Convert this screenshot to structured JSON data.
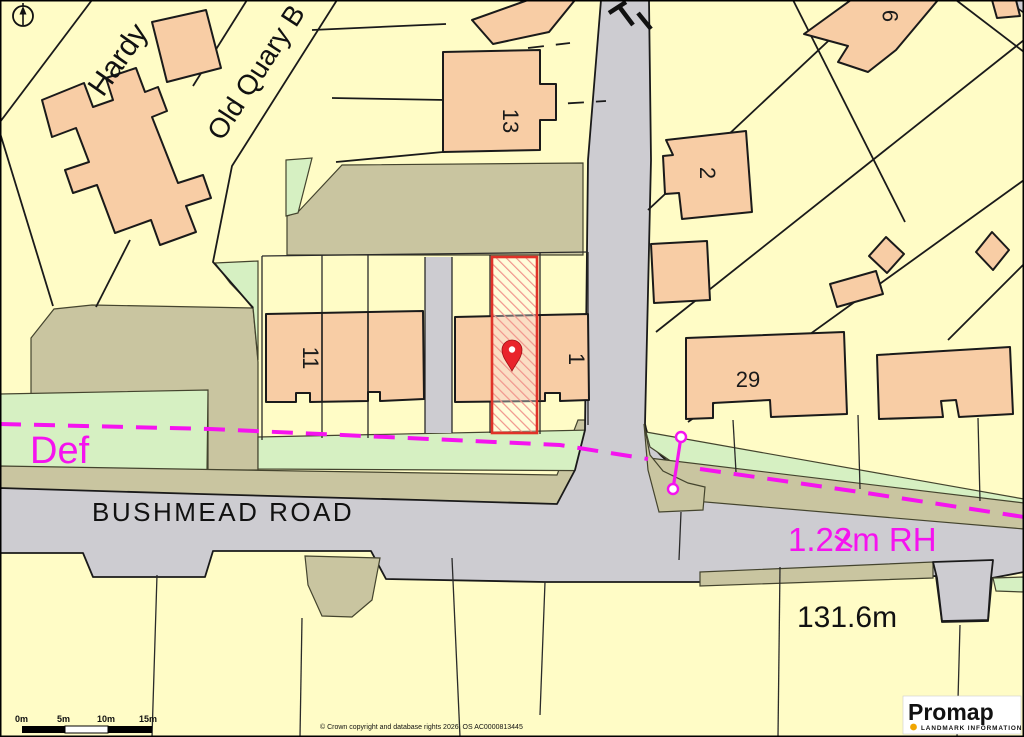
{
  "map": {
    "street_labels": {
      "hardy": "Hardy",
      "old_quary": "Old Quary B",
      "bushmead": "BUSHMEAD ROAD"
    },
    "house_numbers": {
      "n13": "13",
      "n2": "2",
      "n9": "9",
      "n11": "11",
      "n1": "1",
      "n29": "29"
    },
    "annotations": {
      "def": "Def",
      "fence": "1.22m RH",
      "spot_height": "131.6m"
    },
    "scale_bar": {
      "labels": [
        "0m",
        "5m",
        "10m",
        "15m"
      ]
    },
    "copyright": "© Crown copyright and database rights 2026. OS AC0000813445",
    "logo": {
      "brand": "Promap",
      "tagline": "LANDMARK INFORMATION"
    },
    "colors": {
      "parcel_yellow": "#FFFCC6",
      "building_peach": "#F8CDA5",
      "road_grey": "#CDCCD1",
      "verge_green": "#D6F0C2",
      "path_khaki": "#C9C5A0",
      "boundary_magenta": "#F513EF",
      "plot_red": "#E03228",
      "pin_red": "#E9242B",
      "logo_orange": "#F0A500"
    }
  }
}
